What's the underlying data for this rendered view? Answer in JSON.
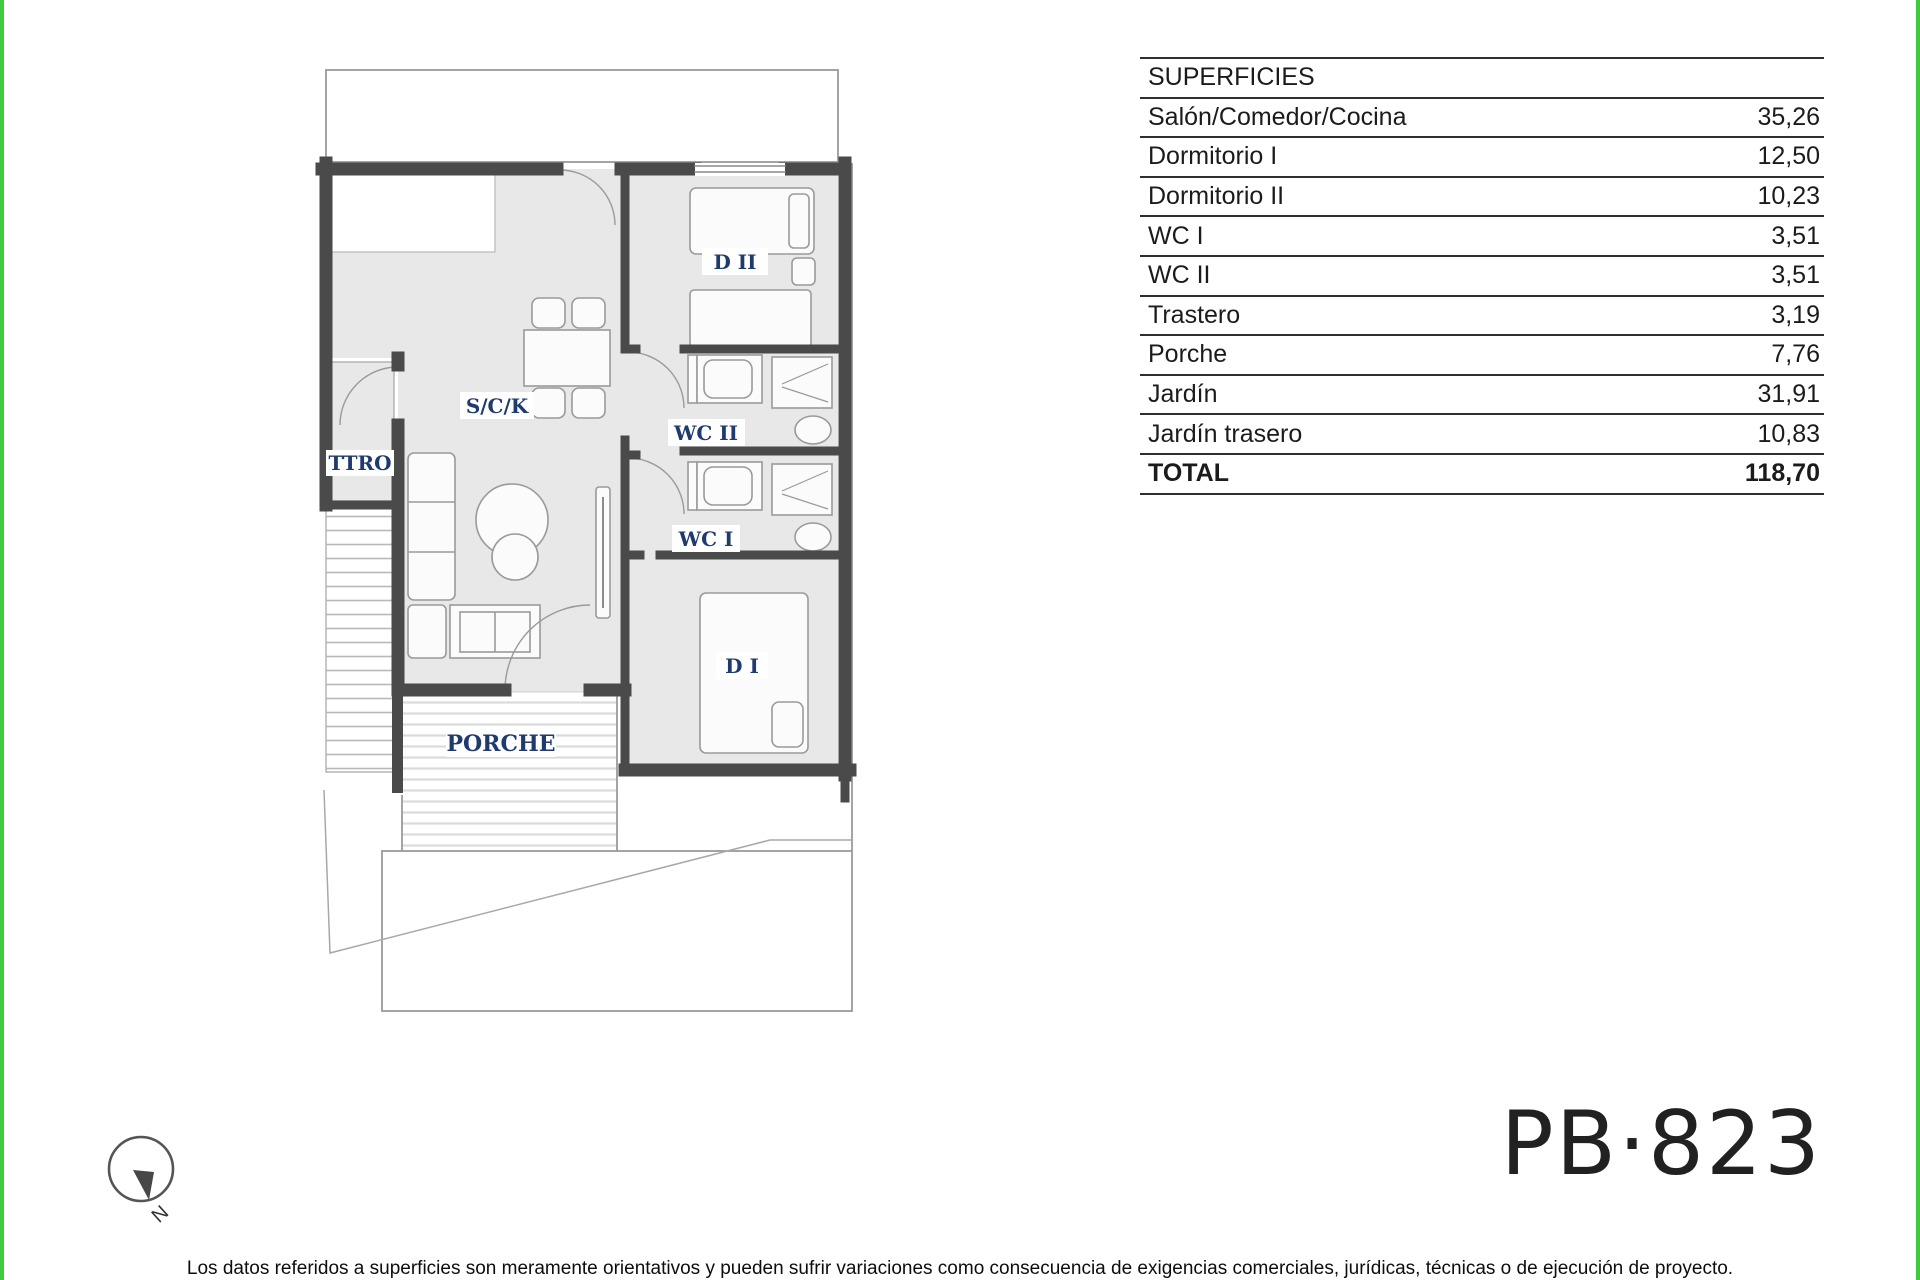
{
  "colors": {
    "accent_green": "#3ecb3e",
    "plan_label_blue": "#1e3a6e",
    "wall_gray": "#4a4a4a",
    "floor_gray": "#e8e8e8"
  },
  "surfaces_table": {
    "header": "SUPERFICIES",
    "rows": [
      {
        "label": "Salón/Comedor/Cocina",
        "value": "35,26"
      },
      {
        "label": "Dormitorio I",
        "value": "12,50"
      },
      {
        "label": "Dormitorio II",
        "value": "10,23"
      },
      {
        "label": "WC I",
        "value": "3,51"
      },
      {
        "label": "WC II",
        "value": "3,51"
      },
      {
        "label": "Trastero",
        "value": "3,19"
      },
      {
        "label": "Porche",
        "value": "7,76"
      },
      {
        "label": "Jardín",
        "value": "31,91"
      },
      {
        "label": "Jardín trasero",
        "value": "10,83"
      }
    ],
    "total_label": "TOTAL",
    "total_value": "118,70"
  },
  "plan_labels": {
    "salon_comedor_cocina": "S/C/K",
    "trastero": "TTRO",
    "dormitorio2": "D II",
    "wc2": "WC II",
    "wc1": "WC I",
    "dormitorio1": "D I",
    "porche": "PORCHE"
  },
  "compass": {
    "letter": "N"
  },
  "plan_code": "PB·823",
  "disclaimer": "Los datos referidos a superficies son meramente orientativos y pueden sufrir variaciones como consecuencia de exigencias comerciales, jurídicas, técnicas o de ejecución de proyecto."
}
